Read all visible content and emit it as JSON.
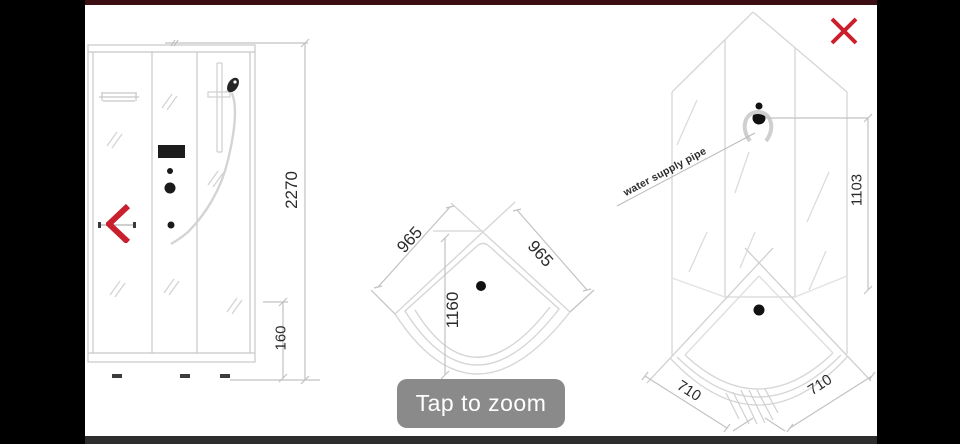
{
  "viewer": {
    "tap_to_zoom": "Tap to zoom",
    "icons": {
      "close": "×",
      "back_chevron": "‹"
    },
    "colors": {
      "accent_red": "#c8202e",
      "header_bar": "#3a0e13",
      "footer_bar": "#2d2d2d",
      "zoom_button_bg": "#8a8a8a",
      "letterbox": "#000000",
      "canvas": "#ffffff"
    }
  },
  "diagram": {
    "front_view": {
      "overall_height": "2270",
      "tray_height": "160"
    },
    "top_view": {
      "left_side": "965",
      "right_side": "965",
      "front_width": "1160"
    },
    "corner_view": {
      "pipe_note": "water supply pipe",
      "wall_height": "1103",
      "tray_left_side": "710",
      "tray_right_side": "710"
    }
  }
}
